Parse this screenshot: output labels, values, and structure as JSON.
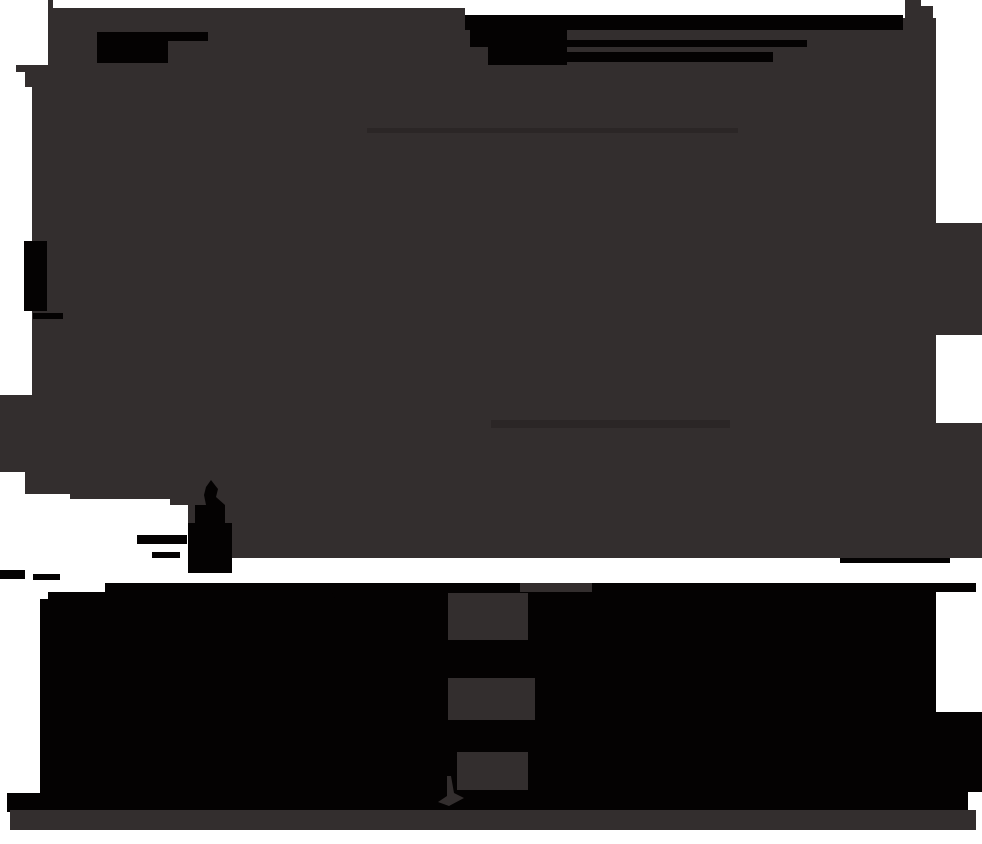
{
  "canvas": {
    "width": 982,
    "height": 844
  },
  "colors": {
    "white": "#ffffff",
    "field": "#332e2e",
    "black": "#040202",
    "faint_line": "#2b2626"
  },
  "shapes": {
    "backdrop": "M0,0 H982 V844 H0 Z",
    "main_silhouette": "M55,8 L465,8 L465,15 L903,15 L903,18 L905,18 L905,0 L921,0 L921,6 L933,6 L933,18 L936,18 L936,223 L982,223 L982,335 L936,335 L936,423 L982,423 L982,558 L240,558 L188,558 L188,505 L170,505 L170,499 L70,499 L70,494 L25,494 L25,472 L0,472 L0,395 L32,395 L32,87 L25,87 L25,72 L16,72 L16,65 L48,65 L48,0 L53,0 L53,8 Z",
    "faint_streak_upper": "M367,128 H738 V133 H367 Z",
    "faint_streak_lower": "M491,420 H730 V428 H491 Z",
    "black_flag_bar": "M97,32 L208,32 L208,41 L168,41 L168,63 L97,63 Z",
    "black_top_band": "M533,15 H903 V30 H533 Z",
    "black_top_blob": "M465,15 H533 V47 H470 V30 H465 Z",
    "black_top_mass": "M488,30 H567 V65 H488 Z",
    "black_streak_mid": "M560,40 H807 V47 H560 Z",
    "black_streak_low": "M560,52 H773 V62 H560 Z",
    "black_left_bar": "M24,241 H47 V311 H24 Z",
    "black_left_bar_foot": "M33,313 H63 V319 H33 Z",
    "obelisk_silhouette": "M211,480 L218,489 L216,497 L225,505 L225,523 L232,523 L232,573 L188,573 L188,523 L195,523 L195,505 L206,505 L204,495 L206,487 Z",
    "fragment_left_a": "M137,535 H187 V544 H137 Z",
    "fragment_left_b": "M152,552 H180 V558 H152 Z",
    "fragment_edge_a": "M0,570 H25 V579 H0 Z",
    "fragment_edge_b": "M33,574 H60 V580 H33 Z",
    "thin_black_ledge": "M840,558 H950 V563 H840 Z",
    "lower_black_band": "M105,583 L976,583 L976,592 L936,592 L936,712 L982,712 L982,792 L968,792 L968,810 L40,810 L40,599 L48,599 L48,592 L105,592 Z",
    "diagonal_spur": "M328,584 L455,592 L455,599 L335,599 Z",
    "window_glow_top": "M448,593 H528 V640 H448 Z",
    "window_glow_middle": "M448,678 H535 V720 H448 Z",
    "window_glow_bottom": "M457,752 H528 V790 H457 Z",
    "window_glow_strip": "M520,583 H592 V592 H520 Z",
    "hook_silhouette": "M451,776 L454,793 L464,798 L449,806 L438,802 L447,796 L447,776 Z",
    "corner_black_block": "M7,793 H40 V812 H7 Z",
    "bottom_gray_strip": "M10,810 H976 V830 H10 Z"
  }
}
